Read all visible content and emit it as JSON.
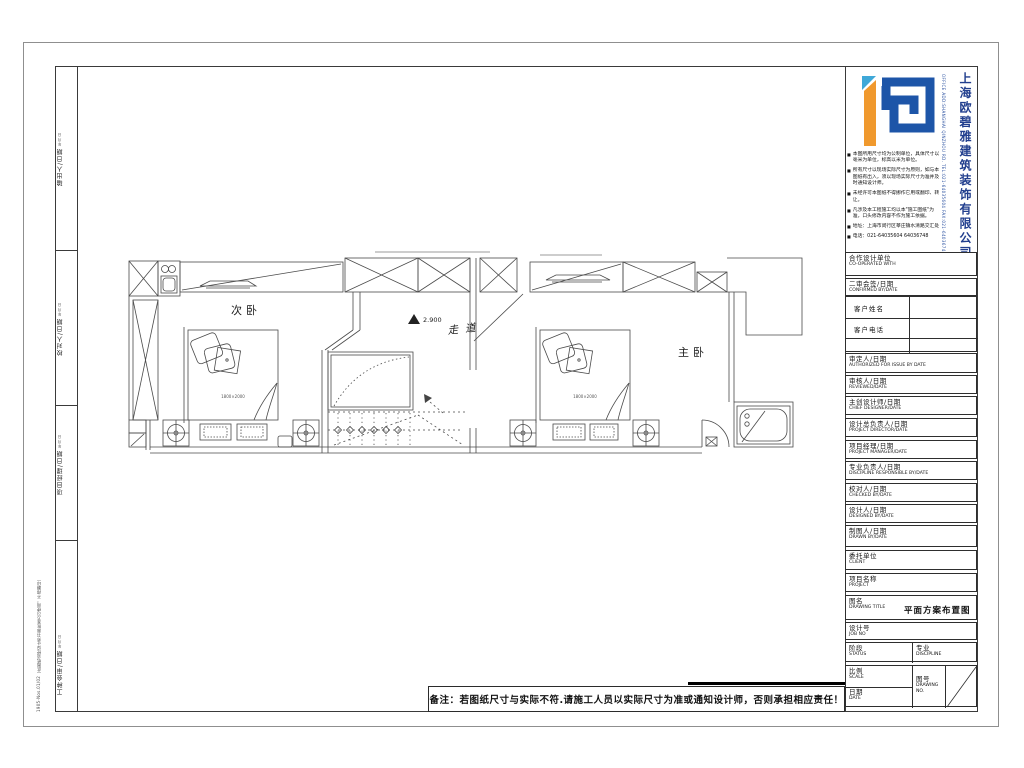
{
  "company": {
    "name": "上海欧碧雅建筑装饰有限公司",
    "contact": "OFFICE ADD:SHANGHAI QINZHOU RD. TEL:021-64035604 FAX:021-64036748",
    "notes": [
      "本图所用尺寸均为公制单位，具体尺寸以毫米为单位，标高以米为单位。",
      "所有尺寸以现场实际尺寸为原则，如与本图纸有出入，须以现场实际尺寸为准并及时通知设计师。",
      "未经许可本图纸不得挪作它用或翻印、转让。",
      "凡涉及本工程施工均以本\"施工图纸\"为准，口头修改内容不作为施工依据。",
      "地址：上海市闵行区莘庄镇水清路交汇处",
      "电话：021-64035604 64036748"
    ]
  },
  "left_strip": {
    "fields": [
      {
        "label": "输出人/日期",
        "sub": "年 月 日"
      },
      {
        "label": "校对人/日期",
        "sub": "年 月 日"
      },
      {
        "label": "项目经理/日期",
        "sub": "年 月 日"
      },
      {
        "label": "工种会审/日期",
        "sub": "年 月 日"
      }
    ],
    "edge_note": "1905-Nos.01/02（此图纸须经设计师书面批准方可使用，不得翻印）"
  },
  "title_block": {
    "rows": [
      {
        "zh": "合作设计单位",
        "en": "CO-OPERATED WITH"
      },
      {
        "zh": "二审会签/日期",
        "en": "CONFIRMED BY/DATE"
      },
      {
        "zh": "审定人/日期",
        "en": "AUTHORIZED FOR ISSUE BY DATE"
      },
      {
        "zh": "审核人/日期",
        "en": "REVIEWED/DATE"
      },
      {
        "zh": "主创设计师/日期",
        "en": "CHIEF DESIGNER/DATE"
      },
      {
        "zh": "设计总负责人/日期",
        "en": "PROJECT DIRECTOR/DATE"
      },
      {
        "zh": "项目经理/日期",
        "en": "PROJECT MANAGER/DATE"
      },
      {
        "zh": "专业负责人/日期",
        "en": "DISCIPLINE RESPONSIBLE BY/DATE"
      },
      {
        "zh": "校对人/日期",
        "en": "CHECKED BY/DATE"
      },
      {
        "zh": "设计人/日期",
        "en": "DESIGNED BY/DATE"
      },
      {
        "zh": "制图人/日期",
        "en": "DRAWN BY/DATE"
      },
      {
        "zh": "委托单位",
        "en": "CLIENT"
      },
      {
        "zh": "项目名称",
        "en": "PROJECT"
      },
      {
        "zh": "图名",
        "en": "DRAWING TITLE"
      },
      {
        "zh": "设计号",
        "en": "JOB NO"
      }
    ],
    "client": {
      "name_label": "客户姓名",
      "phone_label": "客户电话"
    },
    "status": {
      "zh": "阶段",
      "en": "STATUS"
    },
    "discipline": {
      "zh": "专业",
      "en": "DISCIPLINE"
    },
    "scale": {
      "zh": "比例",
      "en": "SCALE"
    },
    "date": {
      "zh": "日期",
      "en": "DATE"
    },
    "drawing_no": {
      "zh": "图号",
      "en": "DRAWING NO."
    },
    "drawing_title_value": "平面方案布置图"
  },
  "plan": {
    "rooms": [
      {
        "label": "次卧"
      },
      {
        "label": "走道"
      },
      {
        "label": "主卧"
      }
    ],
    "elevation": "2.900",
    "bed_label": "1800×2000"
  },
  "footer": {
    "note": "备注：若图纸尺寸与实际不符.请施工人员以实际尺寸为准或通知设计师，否则承担相应责任！"
  },
  "colors": {
    "logo_orange": "#F0992E",
    "logo_blue": "#1D55A8",
    "company_navy": "#223F8E"
  }
}
